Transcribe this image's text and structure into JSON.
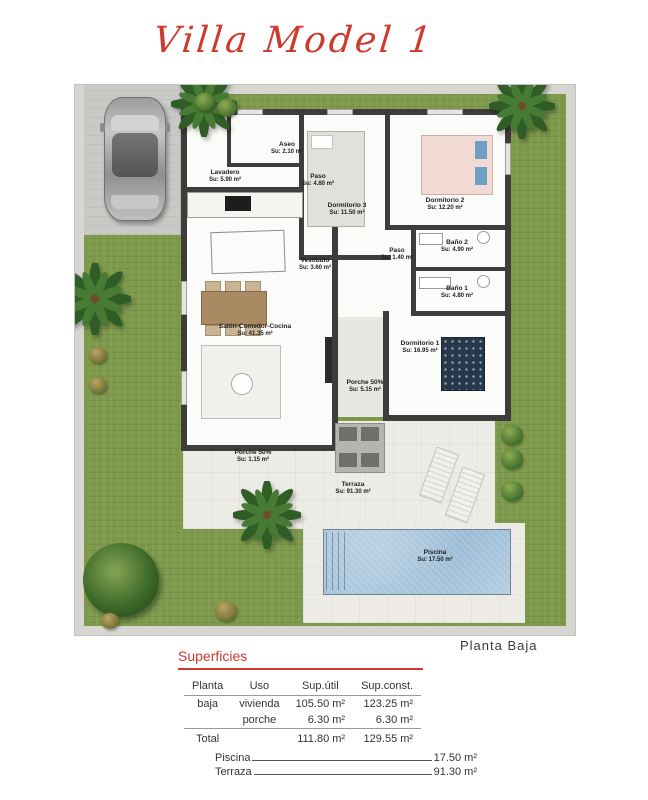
{
  "title": "Villa Model 1",
  "plan_label": "Planta Baja",
  "rooms": {
    "lavadero": {
      "name": "Lavadero",
      "area": "Su: 5.90 m²"
    },
    "aseo": {
      "name": "Aseo",
      "area": "Su: 2.10 m²"
    },
    "paso": {
      "name": "Paso",
      "area": "Su: 4.80 m²"
    },
    "dormitorio3": {
      "name": "Dormitorio 3",
      "area": "Su: 11.50 m²"
    },
    "dormitorio2": {
      "name": "Dormitorio 2",
      "area": "Su: 12.20 m²"
    },
    "bano2": {
      "name": "Baño 2",
      "area": "Su: 4.90 m²"
    },
    "bano1": {
      "name": "Baño 1",
      "area": "Su: 4.80 m²"
    },
    "paso2": {
      "name": "Paso",
      "area": "Su: 1.40 m²"
    },
    "vestibulo": {
      "name": "Vestíbulo",
      "area": "Su: 3.60 m²"
    },
    "salon": {
      "name": "Salón-Comedor-Cocina",
      "area": "Su: 41.35 m²"
    },
    "dormitorio1": {
      "name": "Dormitorio 1",
      "area": "Su: 16.95 m²"
    },
    "porche1": {
      "name": "Porche 50%",
      "area": "Su: 5.15 m²"
    },
    "porche2": {
      "name": "Porche 50%",
      "area": "Su: 1.15 m²"
    },
    "terraza": {
      "name": "Terraza",
      "area": "Su: 91.30 m²"
    },
    "piscina": {
      "name": "Piscina",
      "area": "Su: 17.50 m²"
    }
  },
  "superficies": {
    "heading": "Superficies",
    "columns": {
      "planta": "Planta",
      "uso": "Uso",
      "util": "Sup.útil",
      "const": "Sup.const."
    },
    "rows": [
      {
        "planta": "baja",
        "uso": "vivienda",
        "util": "105.50 m²",
        "const": "123.25 m²"
      },
      {
        "planta": "",
        "uso": "porche",
        "util": "6.30 m²",
        "const": "6.30 m²"
      }
    ],
    "total": {
      "label": "Total",
      "util": "111.80 m²",
      "const": "129.55 m²"
    },
    "extras": [
      {
        "label": "Piscina",
        "value": "17.50 m²"
      },
      {
        "label": "Terraza",
        "value": "91.30 m²"
      }
    ]
  },
  "colors": {
    "accent_red": "#cf3a2f",
    "garden_green": "#7d9a4b",
    "pool_blue": "#a9c6dc",
    "wall_dark": "#3e3d3b",
    "path_gray": "#d7d6d1"
  }
}
